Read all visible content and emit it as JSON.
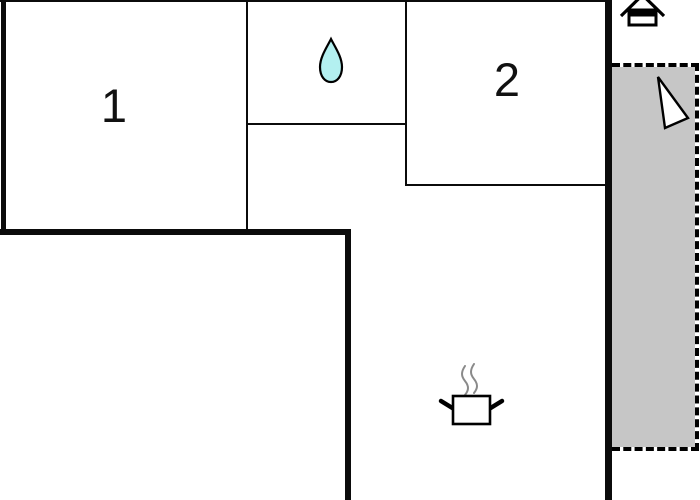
{
  "floorplan": {
    "rooms": [
      {
        "name": "room-1",
        "label": "1"
      },
      {
        "name": "room-2",
        "label": "2"
      }
    ],
    "icons": [
      {
        "name": "water-drop-icon",
        "meaning": "bathroom"
      },
      {
        "name": "house-icon",
        "meaning": "entrance"
      },
      {
        "name": "arrow-icon",
        "meaning": "terrace-direction"
      },
      {
        "name": "cooking-pot-icon",
        "meaning": "kitchen"
      }
    ],
    "colors": {
      "wall": "#0b0b0b",
      "partition": "#0b0b0b",
      "terrace_fill": "#c6c6c6",
      "water_drop_fill": "#b3f0f0",
      "steam": "#8a8a8a",
      "icon_fill": "#ffffff",
      "icon_stroke": "#000000",
      "background": "#ffffff"
    }
  }
}
